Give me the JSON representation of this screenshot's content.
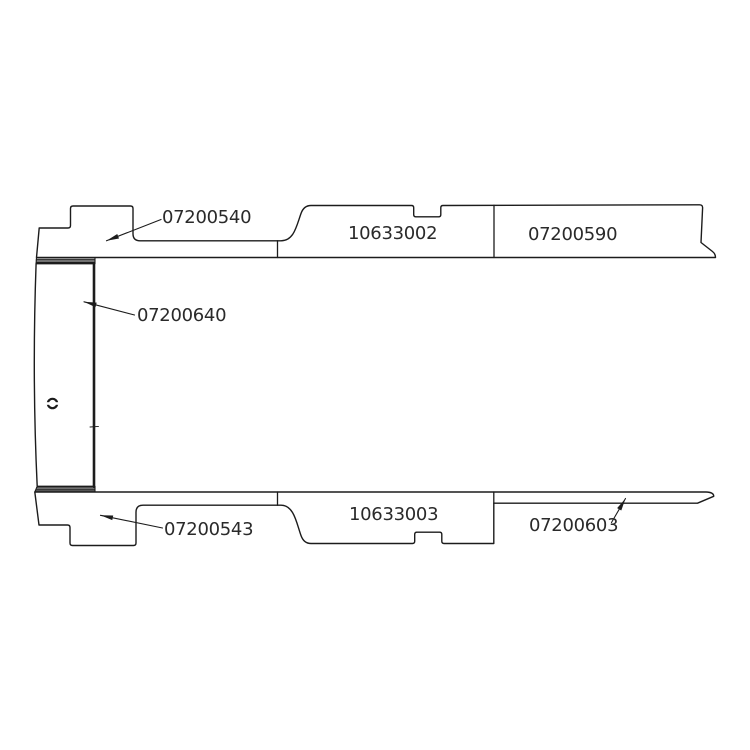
{
  "diagram": {
    "type": "technical-parts-diagram",
    "description": "Exploded side-profile parts diagram of vehicle floor/sill trim panels with numbered part callouts",
    "colors": {
      "background": "#ffffff",
      "line": "#1c1c1c",
      "text": "#2a2a2a"
    },
    "parts": [
      {
        "number": "07200540",
        "location": "upper-left stepped panel",
        "has_leader_arrow": true
      },
      {
        "number": "10633002",
        "location": "upper-middle panel",
        "has_leader_arrow": false
      },
      {
        "number": "07200590",
        "location": "upper-right panel",
        "has_leader_arrow": false
      },
      {
        "number": "07200640",
        "location": "left vertical door panel",
        "has_leader_arrow": true
      },
      {
        "number": "07200543",
        "location": "lower-left stepped panel",
        "has_leader_arrow": true
      },
      {
        "number": "10633003",
        "location": "lower-middle panel",
        "has_leader_arrow": false
      },
      {
        "number": "07200603",
        "location": "lower-right tapered strip",
        "has_leader_arrow": true
      }
    ]
  }
}
